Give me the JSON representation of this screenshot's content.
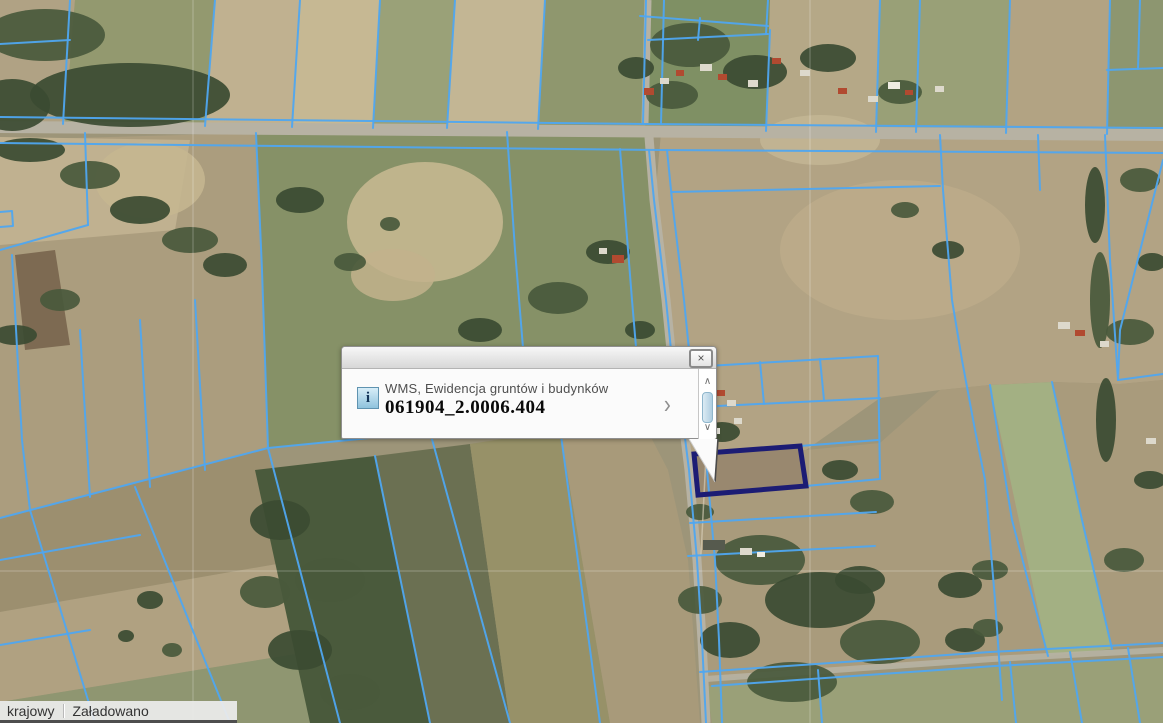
{
  "info_window": {
    "source_layer": "WMS, Ewidencja gruntów i budynków",
    "feature_id": "061904_2.0006.404",
    "close_glyph": "×",
    "details_glyph": "›",
    "scroll_up_glyph": "∧",
    "scroll_down_glyph": "∨",
    "info_glyph": "i"
  },
  "status_bar": {
    "layer_name": "krajowy",
    "load_status": "Załadowano"
  },
  "map": {
    "size": [
      1163,
      723
    ],
    "colors": {
      "overlay": "#4FA6F0",
      "highlight": "#1C1C74",
      "road": "#b7b2a3",
      "tree": "#49593c",
      "tree_dark": "#3b4b32",
      "grid": "#ffffff",
      "track": "#d8d0ba"
    },
    "patches": [
      [
        "0,0 1163,0 1163,723 0,723",
        "#9d9579"
      ],
      [
        "0,0 75,0 65,125 0,122",
        "#b0a284"
      ],
      [
        "75,0 215,0 205,126 65,125",
        "#93996f"
      ],
      [
        "215,0 300,0 292,127 205,126",
        "#c0b190"
      ],
      [
        "300,0 380,0 373,128 292,127",
        "#c6b893"
      ],
      [
        "380,0 455,0 447,128 373,128",
        "#9aa178"
      ],
      [
        "455,0 545,0 538,129 447,128",
        "#c3b694"
      ],
      [
        "545,0 650,0 645,130 538,129",
        "#8f976e"
      ],
      [
        "650,0 770,0 766,131 645,130",
        "#7f9064"
      ],
      [
        "770,0 880,0 876,132 766,131",
        "#b5a887"
      ],
      [
        "880,0 1010,0 1006,133 876,132",
        "#99a077"
      ],
      [
        "1010,0 1110,0 1107,134 1006,133",
        "#b2a383"
      ],
      [
        "1110,0 1163,0 1163,135 1107,134",
        "#8d9670"
      ],
      [
        "0,140 256,133 262,270 268,448 0,518",
        "#ab9d7e"
      ],
      [
        "0,137 190,140 175,230 0,245",
        "#c0b190"
      ],
      [
        "15,255 55,250 70,345 25,350",
        "#7d6a52"
      ],
      [
        "256,133 650,131 655,200 668,360 642,420 560,428 430,432 268,448 262,270",
        "#869167"
      ],
      [
        "0,518 268,448 300,560 0,612",
        "#9c8f6f"
      ],
      [
        "0,612 300,560 320,650 0,702",
        "#b0a181"
      ],
      [
        "0,702 320,650 340,723 0,723",
        "#8f9671"
      ],
      [
        "255,470 375,456 430,723 310,723",
        "#4a5a3c"
      ],
      [
        "375,456 470,444 510,723 430,723",
        "#6b7052"
      ],
      [
        "470,444 560,430 610,723 510,723",
        "#979168"
      ],
      [
        "560,430 642,420 668,470 688,560 700,723 610,723",
        "#a89a7a"
      ],
      [
        "661,133 1163,137 1163,380 1120,384 1052,382 990,385 940,390 880,398 806,450 694,456 686,470 668,360 655,200",
        "#b2a384"
      ],
      [
        "694,456 806,450 880,443 940,390 990,385 1052,382 1120,384 1163,380 1163,643 992,659 706,679 697,560 688,500",
        "#a99b7c"
      ],
      [
        "990,385 1052,382 1112,649 1048,656",
        "#a3b083"
      ],
      [
        "706,686 995,667 1163,658 1163,723 712,723",
        "#9aa078"
      ],
      [
        "694,454 800,446 806,486 698,495",
        "#99886f"
      ]
    ],
    "light_patches": [
      [
        425,
        222,
        78,
        60,
        "#c9ba93"
      ],
      [
        393,
        275,
        42,
        26,
        "#c2b28c"
      ],
      [
        900,
        250,
        120,
        70,
        "#bcab8a"
      ],
      [
        820,
        140,
        60,
        25,
        "#c3b694"
      ],
      [
        150,
        180,
        55,
        38,
        "#c6b791"
      ]
    ],
    "roads": {
      "horizontal": "0,121 1163,129 1163,141 0,133",
      "vertical_top": "648,0 645,123",
      "vertical": "649,137 654,200 666,300 672,360 684,430 689,470 697,560 702,640 706,723",
      "diagonal": "706,679 992,659 1163,650"
    },
    "trees": [
      [
        45,
        35,
        60,
        26,
        0
      ],
      [
        130,
        95,
        100,
        32,
        1
      ],
      [
        12,
        105,
        38,
        26,
        1
      ],
      [
        30,
        150,
        35,
        12,
        1
      ],
      [
        90,
        175,
        30,
        14,
        0
      ],
      [
        140,
        210,
        30,
        14,
        1
      ],
      [
        190,
        240,
        28,
        13,
        0
      ],
      [
        225,
        265,
        22,
        12,
        1
      ],
      [
        15,
        335,
        22,
        10,
        1
      ],
      [
        60,
        300,
        20,
        11,
        0
      ],
      [
        690,
        45,
        40,
        22,
        0
      ],
      [
        755,
        72,
        32,
        17,
        1
      ],
      [
        672,
        95,
        26,
        14,
        0
      ],
      [
        828,
        58,
        28,
        14,
        1
      ],
      [
        900,
        92,
        22,
        12,
        0
      ],
      [
        636,
        68,
        18,
        11,
        1
      ],
      [
        300,
        200,
        24,
        13,
        1
      ],
      [
        390,
        224,
        10,
        7,
        0
      ],
      [
        480,
        330,
        22,
        12,
        1
      ],
      [
        558,
        298,
        30,
        16,
        0
      ],
      [
        608,
        252,
        22,
        12,
        1
      ],
      [
        584,
        380,
        26,
        13,
        0
      ],
      [
        640,
        330,
        15,
        9,
        1
      ],
      [
        520,
        428,
        20,
        10,
        0
      ],
      [
        452,
        400,
        14,
        8,
        1
      ],
      [
        350,
        262,
        16,
        9,
        0
      ],
      [
        280,
        520,
        30,
        20,
        1
      ],
      [
        330,
        580,
        35,
        22,
        0
      ],
      [
        300,
        650,
        32,
        20,
        1
      ],
      [
        350,
        692,
        30,
        18,
        0
      ],
      [
        265,
        592,
        25,
        16,
        0
      ],
      [
        760,
        560,
        45,
        25,
        0
      ],
      [
        820,
        600,
        55,
        28,
        1
      ],
      [
        880,
        642,
        40,
        22,
        0
      ],
      [
        730,
        640,
        30,
        18,
        1
      ],
      [
        792,
        682,
        45,
        20,
        0
      ],
      [
        860,
        580,
        25,
        14,
        1
      ],
      [
        700,
        600,
        22,
        14,
        0
      ],
      [
        840,
        470,
        18,
        10,
        1
      ],
      [
        872,
        502,
        22,
        12,
        0
      ],
      [
        722,
        432,
        18,
        10,
        1
      ],
      [
        700,
        512,
        14,
        8,
        0
      ],
      [
        1095,
        205,
        10,
        38,
        1
      ],
      [
        1100,
        300,
        10,
        48,
        0
      ],
      [
        1106,
        420,
        10,
        42,
        1
      ],
      [
        1140,
        180,
        20,
        12,
        0
      ],
      [
        1152,
        262,
        14,
        9,
        1
      ],
      [
        1130,
        332,
        24,
        13,
        0
      ],
      [
        1150,
        480,
        16,
        9,
        1
      ],
      [
        1124,
        560,
        20,
        12,
        0
      ],
      [
        150,
        600,
        13,
        9,
        1
      ],
      [
        172,
        650,
        10,
        7,
        0
      ],
      [
        126,
        636,
        8,
        6,
        1
      ],
      [
        960,
        585,
        22,
        13,
        1
      ],
      [
        990,
        570,
        18,
        10,
        0
      ],
      [
        965,
        640,
        20,
        12,
        1
      ],
      [
        988,
        628,
        15,
        9,
        0
      ],
      [
        948,
        250,
        16,
        9,
        1
      ],
      [
        905,
        210,
        14,
        8,
        0
      ]
    ],
    "parcel_lines": [
      "70,0 63,124",
      "215,0 205,126",
      "300,0 292,127",
      "380,0 373,128",
      "455,0 447,128",
      "545,0 538,129",
      "0,44 70,40",
      "880,0 876,132",
      "920,0 916,132",
      "1010,0 1006,133",
      "1110,0 1107,134",
      "1107,70 1163,68",
      "1140,0 1138,69",
      "640,16 768,26",
      "648,40 768,34",
      "768,0 766,34",
      "700,18 698,40",
      "770,30 766,131",
      "0,117 645,124 1163,128",
      "0,143 660,150 1163,153",
      "646,0 643,124",
      "664,0 661,124",
      "649,150 654,200 666,300 672,360 684,430 689,470 697,560 702,640 706,723",
      "667,150 672,200 684,300 690,360 702,430 707,470 715,560 719,640 722,723",
      "85,133 88,225",
      "0,250 88,225",
      "0,212 12,211 13,226 0,227",
      "12,255 22,440 30,510",
      "80,330 90,497",
      "140,320 150,487",
      "195,300 205,470",
      "256,133 262,270 268,448",
      "507,132 515,250 524,360 532,430",
      "620,149 632,300 642,418",
      "0,518 268,448 430,432 560,428 642,420",
      "30,510 95,723",
      "135,487 230,723",
      "268,448 340,723",
      "375,456 430,723",
      "430,432 510,723",
      "560,428 600,723",
      "0,560 140,535",
      "0,645 90,630",
      "672,192 940,186",
      "940,135 943,190 952,300 962,360 975,430 985,480 995,600 1002,700",
      "1038,135 1040,190",
      "990,385 1012,520 1048,656",
      "1052,382 1082,520 1112,649",
      "1105,135 1110,260 1118,380",
      "1163,160 1120,330 1118,380",
      "1118,380 1163,374",
      "700,672 990,652 1163,643",
      "712,686 995,666 1163,657",
      "818,670 822,723",
      "1010,662 1016,723",
      "1070,652 1082,723",
      "1128,648 1140,723",
      "673,368 878,356",
      "678,408 880,398",
      "760,362 764,404",
      "820,359 824,400",
      "800,446 878,440",
      "806,486 880,479",
      "690,523 876,512",
      "688,556 875,546",
      "878,356 880,479"
    ],
    "grid_lines": [
      "193,0 193,723",
      "810,0 810,723",
      "0,571 1163,571"
    ],
    "tracks": [
      "707,436 701,555"
    ],
    "buildings": [
      [
        644,
        88,
        10,
        7,
        "#b14a30"
      ],
      [
        660,
        78,
        9,
        6,
        "#ddd9cc"
      ],
      [
        676,
        70,
        8,
        6,
        "#b14a30"
      ],
      [
        700,
        64,
        12,
        7,
        "#ddd9cc"
      ],
      [
        718,
        74,
        9,
        6,
        "#b14a30"
      ],
      [
        748,
        80,
        10,
        7,
        "#ddd9cc"
      ],
      [
        772,
        58,
        9,
        6,
        "#b14a30"
      ],
      [
        800,
        70,
        10,
        6,
        "#ddd9cc"
      ],
      [
        838,
        88,
        9,
        6,
        "#b14a30"
      ],
      [
        868,
        96,
        10,
        6,
        "#ddd9cc"
      ],
      [
        888,
        82,
        12,
        7,
        "#efece2"
      ],
      [
        905,
        90,
        8,
        5,
        "#b14a30"
      ],
      [
        935,
        86,
        9,
        6,
        "#ddd9cc"
      ],
      [
        612,
        255,
        12,
        8,
        "#b14a30"
      ],
      [
        599,
        248,
        8,
        6,
        "#ddd9cc"
      ],
      [
        1058,
        322,
        12,
        7,
        "#ddd9cc"
      ],
      [
        1075,
        330,
        10,
        6,
        "#b14a30"
      ],
      [
        1100,
        341,
        9,
        6,
        "#ddd9cc"
      ],
      [
        706,
        380,
        10,
        7,
        "#b14a30"
      ],
      [
        717,
        390,
        8,
        6,
        "#b14a30"
      ],
      [
        727,
        400,
        9,
        6,
        "#ddd9cc"
      ],
      [
        734,
        418,
        8,
        6,
        "#ddd9cc"
      ],
      [
        711,
        428,
        9,
        6,
        "#efece2"
      ],
      [
        703,
        540,
        22,
        10,
        "#565a4e"
      ],
      [
        740,
        548,
        12,
        7,
        "#ddd9cc"
      ],
      [
        757,
        552,
        8,
        5,
        "#efece2"
      ],
      [
        1146,
        438,
        10,
        6,
        "#ddd9cc"
      ]
    ],
    "highlight": {
      "points": "694,454 800,446 806,486 698,495",
      "color": "#1C1C74"
    }
  }
}
